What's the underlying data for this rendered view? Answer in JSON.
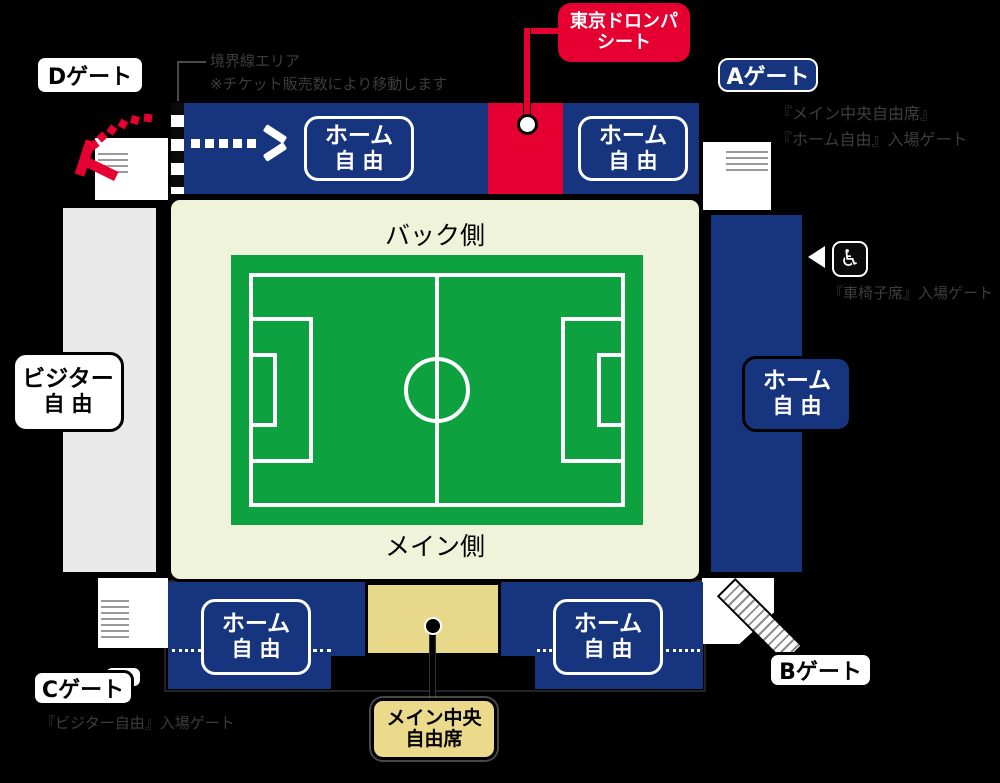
{
  "colors": {
    "background": "#000000",
    "stand_blue": "#17357e",
    "accent_red": "#e60032",
    "pitch_green": "#0da23f",
    "field_bg": "#eef3da",
    "visitor_gray": "#e9e9e9",
    "main_center_yellow": "#e8d88a",
    "label_yellow": "#ecda8c"
  },
  "gates": {
    "a": "Aゲート",
    "b": "Bゲート",
    "c": "Cゲート",
    "d": "Dゲート"
  },
  "labels": {
    "home_l1": "ホーム",
    "home_l2": "自由",
    "visitor_l1": "ビジター",
    "visitor_l2": "自由",
    "dorompa_l1": "東京ドロンパ",
    "dorompa_l2": "シート",
    "main_center_l1": "メイン中央",
    "main_center_l2": "自由席",
    "back_side": "バック側",
    "main_side": "メイン側"
  },
  "notes": {
    "boundary_l1": "境界線エリア",
    "boundary_l2": "※チケット販売数により移動します",
    "a_gate_l1": "『メイン中央自由席』",
    "a_gate_l2": "『ホーム自由』入場ゲート",
    "c_gate": "『ビジター自由』入場ゲート",
    "wheelchair": "『車椅子席』入場ゲート"
  },
  "icons": {
    "wheelchair": "♿"
  }
}
